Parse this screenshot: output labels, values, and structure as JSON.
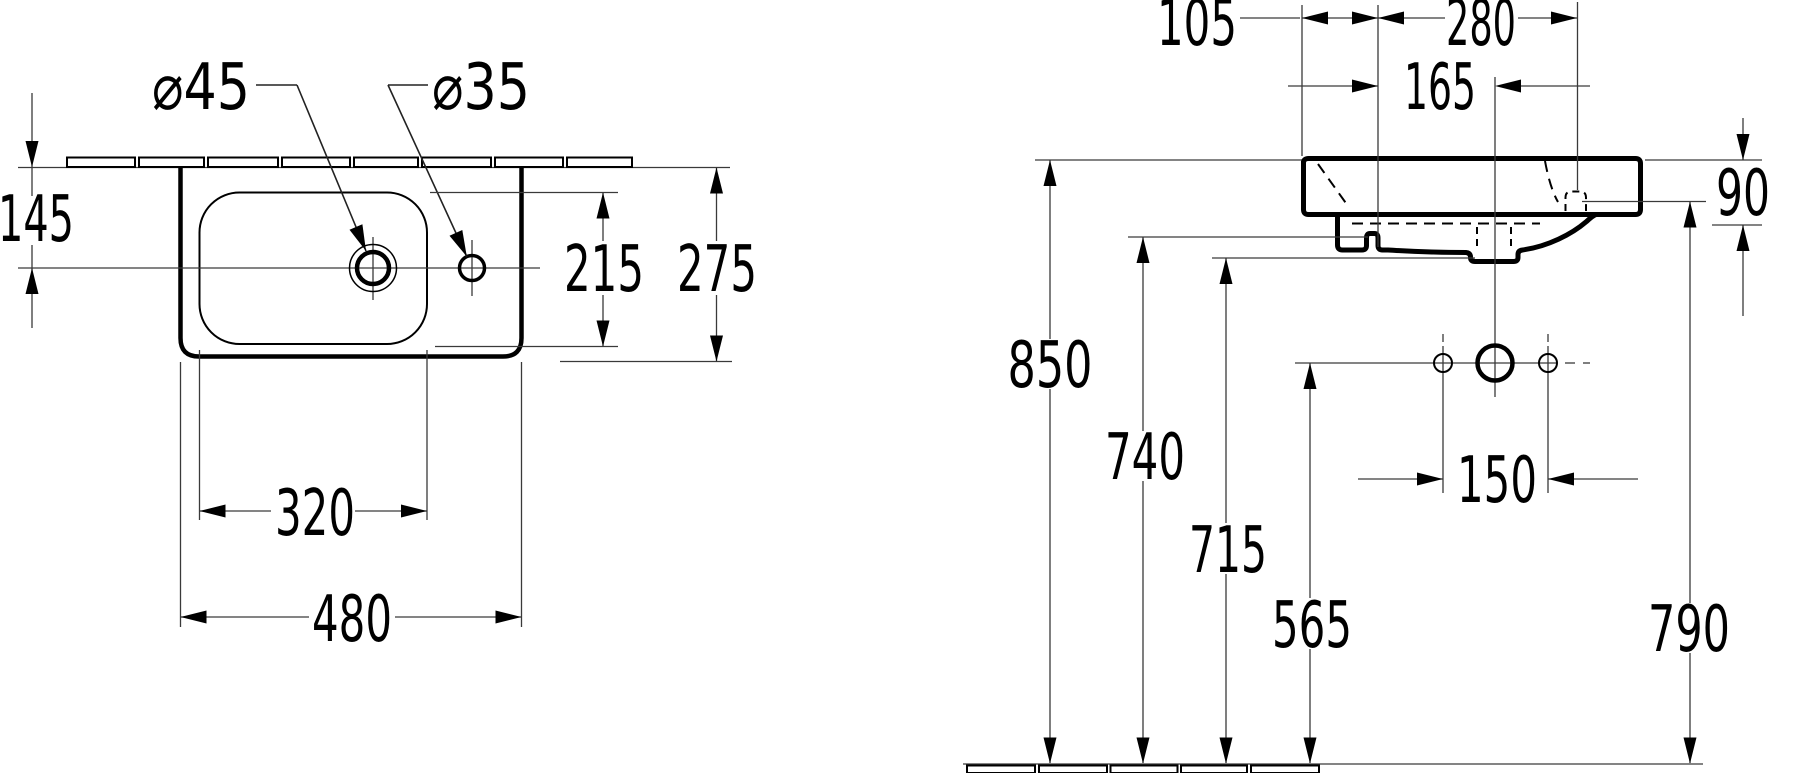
{
  "page": {
    "background_color": "#ffffff",
    "line_color": "#000000",
    "thin_line_color": "#3a3a3a"
  },
  "drawing": {
    "kind": "sanitary-ware dimension drawing",
    "views": [
      {
        "id": "top-view",
        "description": "plan view of washbasin against tiled wall"
      },
      {
        "id": "front-view",
        "description": "side elevation of wall-hung washbasin above floor"
      }
    ]
  },
  "labels": {
    "dia45": "⌀45",
    "dia35": "⌀35",
    "d145": "145",
    "d215": "215",
    "d275": "275",
    "d320": "320",
    "d480": "480",
    "d105": "105",
    "d280": "280",
    "d165": "165",
    "d90": "90",
    "d850": "850",
    "d740": "740",
    "d715": "715",
    "d565": "565",
    "d150": "150",
    "d790": "790"
  }
}
